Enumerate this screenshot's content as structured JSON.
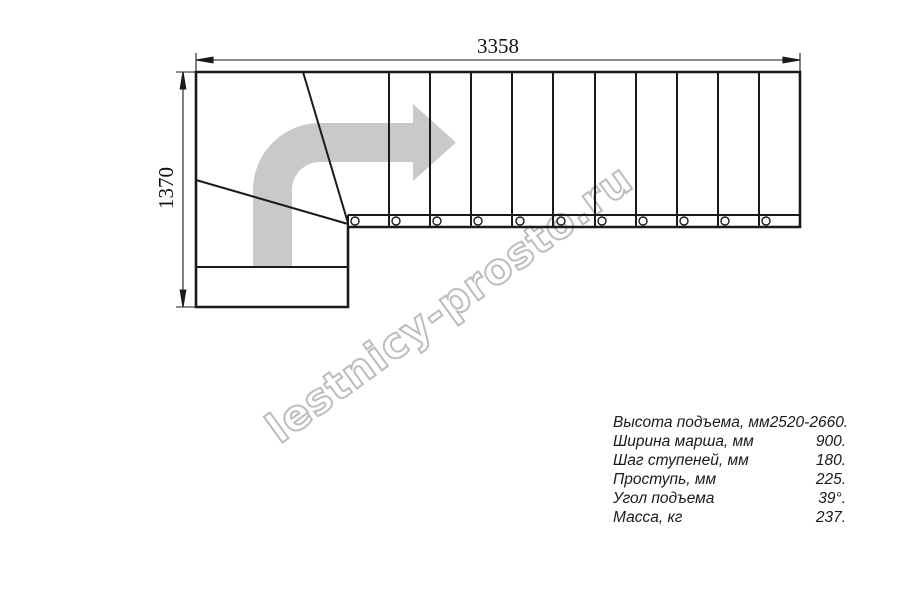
{
  "drawing": {
    "title": "staircase-plan-top-view",
    "dim_width_label": "3358",
    "dim_height_label": "1370"
  },
  "watermark": {
    "text": "lestnicy-prosto.ru"
  },
  "colors": {
    "line": "#1a1a1a",
    "arrow_watermark": "#c9c9c9",
    "watermark_text_outline": "#bdbdbd"
  },
  "specs": {
    "rows": [
      {
        "label": "Высота подъема, мм",
        "value": "2520-2660."
      },
      {
        "label": "Ширина марша, мм",
        "value": "900."
      },
      {
        "label": "Шаг ступеней, мм",
        "value": "180."
      },
      {
        "label": "Проступь, мм",
        "value": "225."
      },
      {
        "label": "Угол подъема",
        "value": "39°."
      },
      {
        "label": "Масса, кг",
        "value": "237."
      }
    ]
  }
}
